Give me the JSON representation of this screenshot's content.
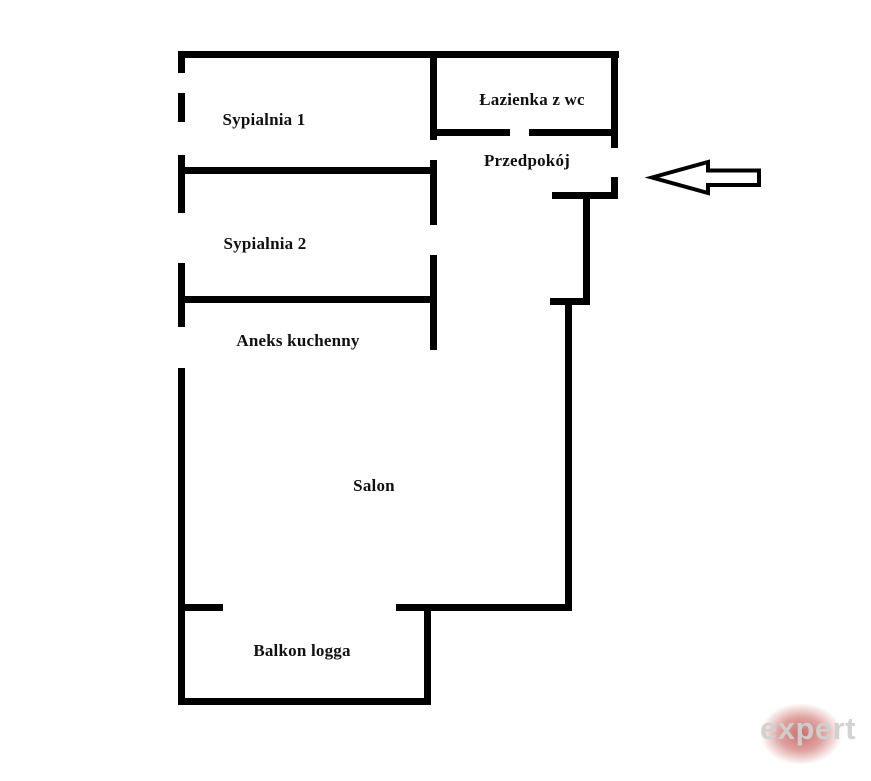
{
  "page": {
    "background_color": "#ffffff",
    "wall_color": "#000000",
    "label_color": "#111111"
  },
  "rooms": [
    {
      "id": "sypialnia-1",
      "label": "Sypialnia 1"
    },
    {
      "id": "lazienka-z-wc",
      "label": "Łazienka z wc"
    },
    {
      "id": "przedpokoj",
      "label": "Przedpokój"
    },
    {
      "id": "sypialnia-2",
      "label": "Sypialnia 2"
    },
    {
      "id": "aneks-kuchenny",
      "label": "Aneks kuchenny"
    },
    {
      "id": "salon",
      "label": "Salon"
    },
    {
      "id": "balkon-logga",
      "label": "Balkon logga"
    }
  ],
  "entrance_arrow": {
    "direction": "left",
    "meaning": "entrance",
    "outline_color": "#000000",
    "fill_color": "#ffffff"
  },
  "watermark": {
    "text": "expert",
    "text_color": "#d0d0d0",
    "blob_color": "#ba3e3a"
  }
}
